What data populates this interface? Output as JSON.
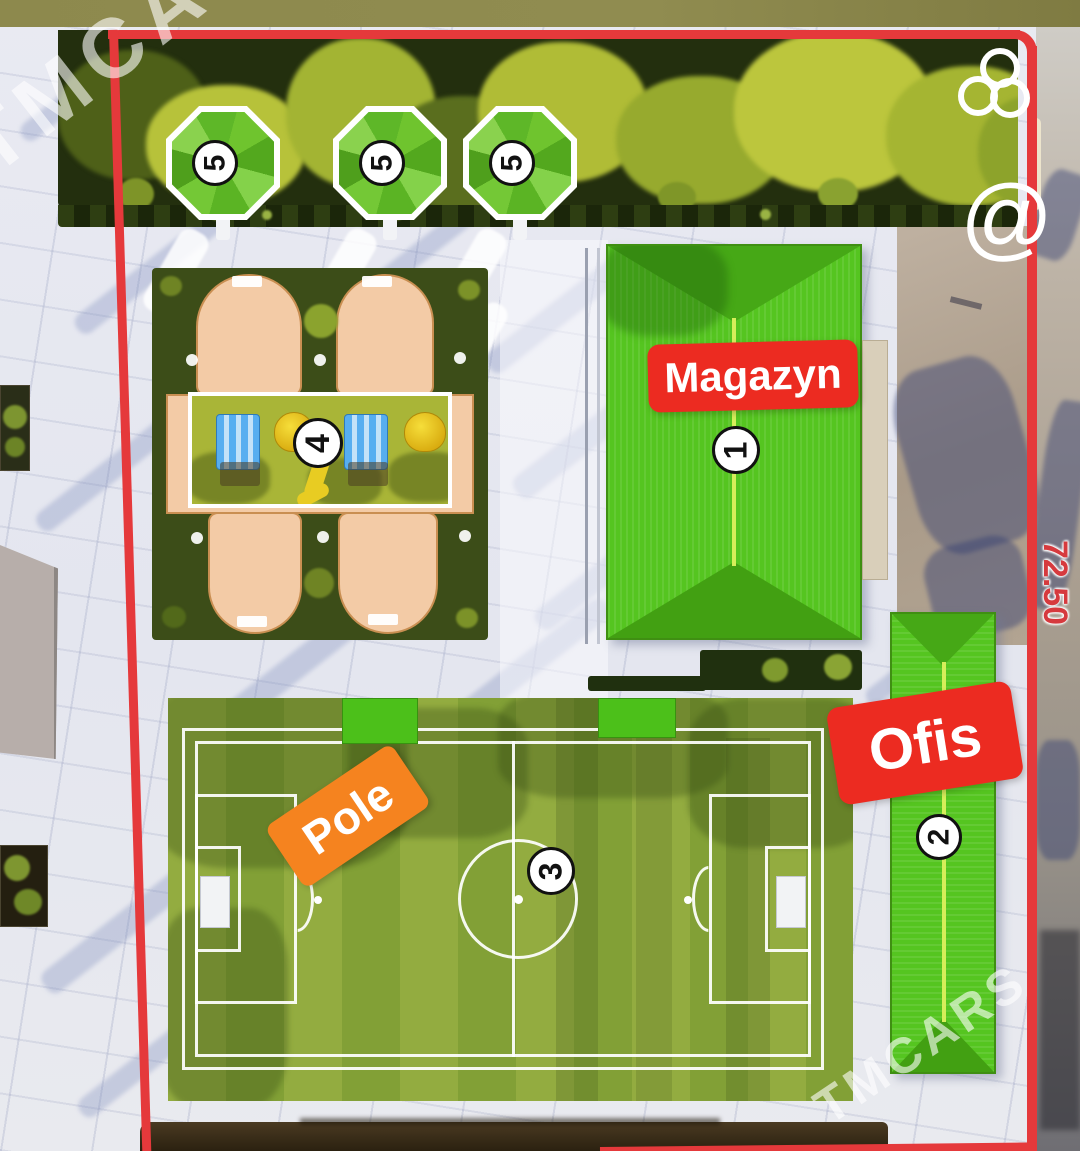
{
  "watermark": {
    "brand_top_left": "TMCARS",
    "brand_bottom_right": "TMCARS",
    "at_symbol": "@",
    "logo_icon": "three-circles-icon"
  },
  "site_plan": {
    "boundary_dimension": "72.50",
    "buildings": {
      "magazyn": {
        "label": "Magazyn",
        "number": "1"
      },
      "ofis": {
        "label": "Ofis",
        "number": "2"
      },
      "field": {
        "label": "Pole",
        "number": "3"
      },
      "playground": {
        "number": "4"
      },
      "gazebos": {
        "numbers": [
          "5",
          "5",
          "5"
        ]
      }
    },
    "colors": {
      "boundary_red": "#e5393b",
      "label_red": "#ec2b21",
      "label_orange": "#f5831f",
      "roof_green": "#55c520",
      "field_green": "#8ca73c",
      "trees_dark": "#232f0e",
      "playground_peach": "#f3cba6",
      "top_bar_olive": "#8d894d"
    }
  }
}
